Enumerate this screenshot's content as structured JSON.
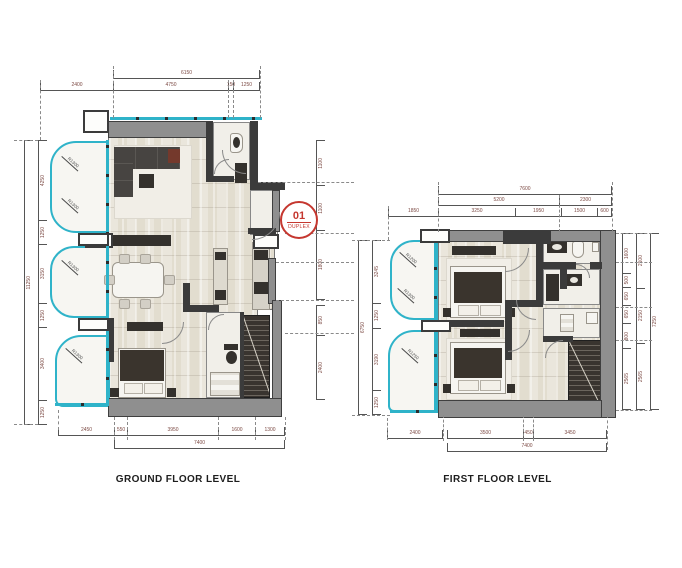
{
  "stamp": {
    "number": "01",
    "label": "DUPLEX"
  },
  "ground_floor": {
    "title": "GROUND FLOOR LEVEL",
    "dims": {
      "top_total": "6150",
      "top_segments": [
        "2400",
        "4750",
        "150",
        "1250"
      ],
      "bottom_segments": [
        "2450",
        "550",
        "3950",
        "1600",
        "1300"
      ],
      "bottom_total": "7400",
      "left_total": "11250",
      "left_segments": [
        "4250",
        "1250",
        "3150",
        "1250",
        "3400",
        "1250"
      ],
      "right_segments": [
        "1100",
        "1100",
        "1800"
      ],
      "right_lower_segments": [
        "850",
        "2400"
      ],
      "radii": [
        "R1300",
        "R1300",
        "R1300",
        "R1300"
      ]
    }
  },
  "first_floor": {
    "title": "FIRST FLOOR LEVEL",
    "dims": {
      "top_total": "7600",
      "top_row2": [
        "5200",
        "2300"
      ],
      "top_row3": [
        "1850",
        "3250",
        "1950",
        "1500",
        "600"
      ],
      "bottom_left": "2400",
      "bottom_segments": [
        "3500",
        "450",
        "3450"
      ],
      "bottom_total": "7400",
      "left_total": "6750",
      "left_segments": [
        "3245",
        "1250",
        "3190",
        "1250"
      ],
      "right_inner_segments": [
        "1600",
        "500",
        "650",
        "650",
        "800",
        "2565"
      ],
      "right_mid_segments": [
        "2100",
        "2150",
        "2565"
      ],
      "right_total": "7250",
      "radii": [
        "R1200",
        "R1300",
        "R1250"
      ]
    }
  },
  "colors": {
    "glazing": "#2fb3c9",
    "wall_gray": "#8f8f8f",
    "wall_dark": "#3b3b3b",
    "floor": "#e8e4da",
    "stamp_red": "#c5372f",
    "dim_text": "#7d4b45"
  }
}
